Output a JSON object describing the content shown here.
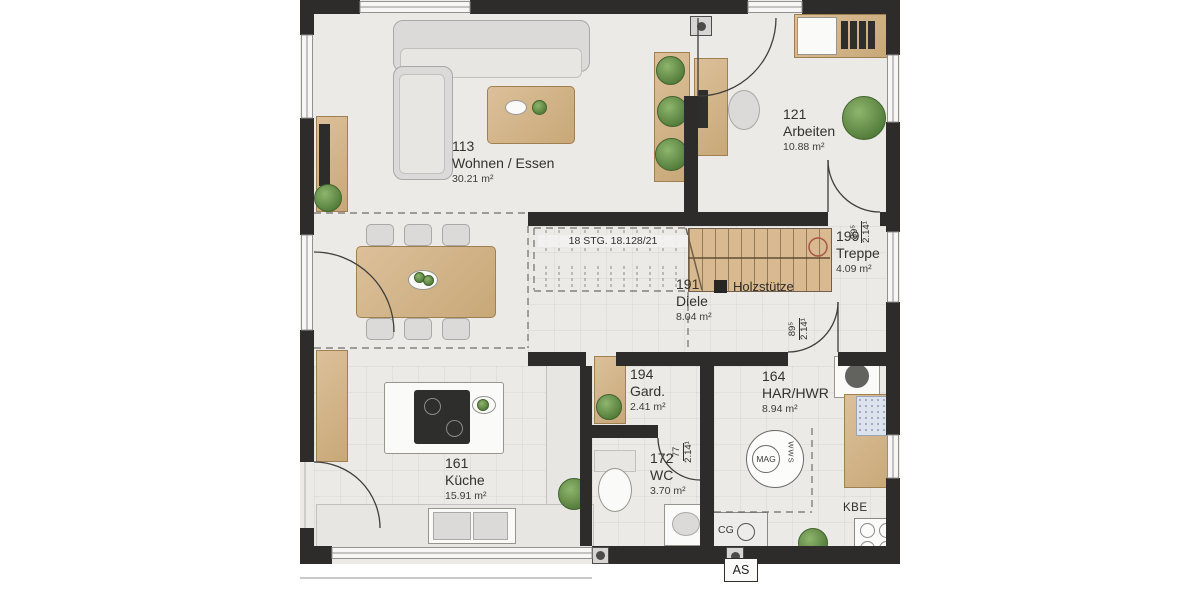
{
  "plan": {
    "rooms": [
      {
        "number": "113",
        "name": "Wohnen / Essen",
        "area": "30.21 m²"
      },
      {
        "number": "121",
        "name": "Arbeiten",
        "area": "10.88 m²"
      },
      {
        "number": "199",
        "name": "Treppe",
        "area": "4.09 m²"
      },
      {
        "number": "191",
        "name": "Diele",
        "area": "8.04 m²"
      },
      {
        "number": "194",
        "name": "Gard.",
        "area": "2.41 m²"
      },
      {
        "number": "164",
        "name": "HAR/HWR",
        "area": "8.94 m²"
      },
      {
        "number": "161",
        "name": "Küche",
        "area": "15.91 m²"
      },
      {
        "number": "172",
        "name": "WC",
        "area": "3.70 m²"
      }
    ],
    "stairs": {
      "note": "18 STG. 18.128/21"
    },
    "legend": {
      "holzstuetze": "Holzstütze"
    },
    "dimensions": [
      {
        "w": "89⁵",
        "h": "2.14¹"
      },
      {
        "w": "89⁵",
        "h": "2.14¹"
      },
      {
        "w": "77",
        "h": "2.14¹"
      }
    ],
    "symbols": {
      "mag": "MAG",
      "wws": "WWS",
      "kbe": "KBE",
      "cg": "CG",
      "as": "AS"
    },
    "colors": {
      "wall": "#2d2c2a",
      "wood": "#d9b98f",
      "floor": "#eceae6",
      "accent_red": "#a8574a"
    }
  }
}
